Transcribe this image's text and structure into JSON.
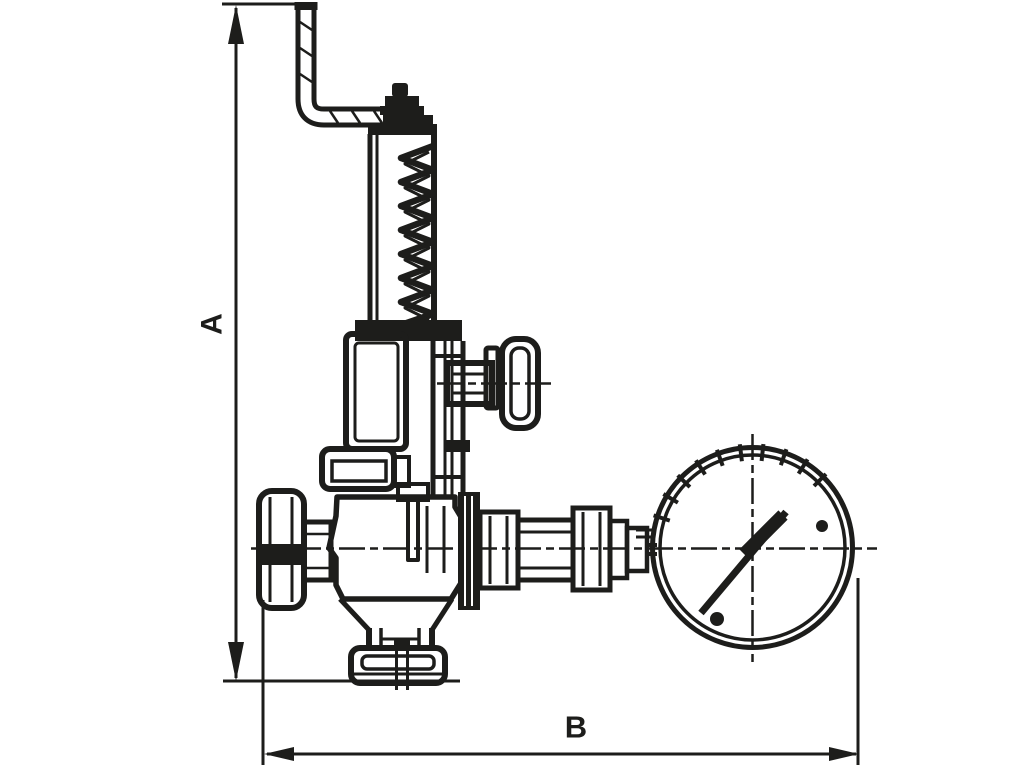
{
  "labels": {
    "dimension_height": "A",
    "dimension_width": "B"
  },
  "colors": {
    "line": "#1d1d1b",
    "background": "#ffffff"
  }
}
